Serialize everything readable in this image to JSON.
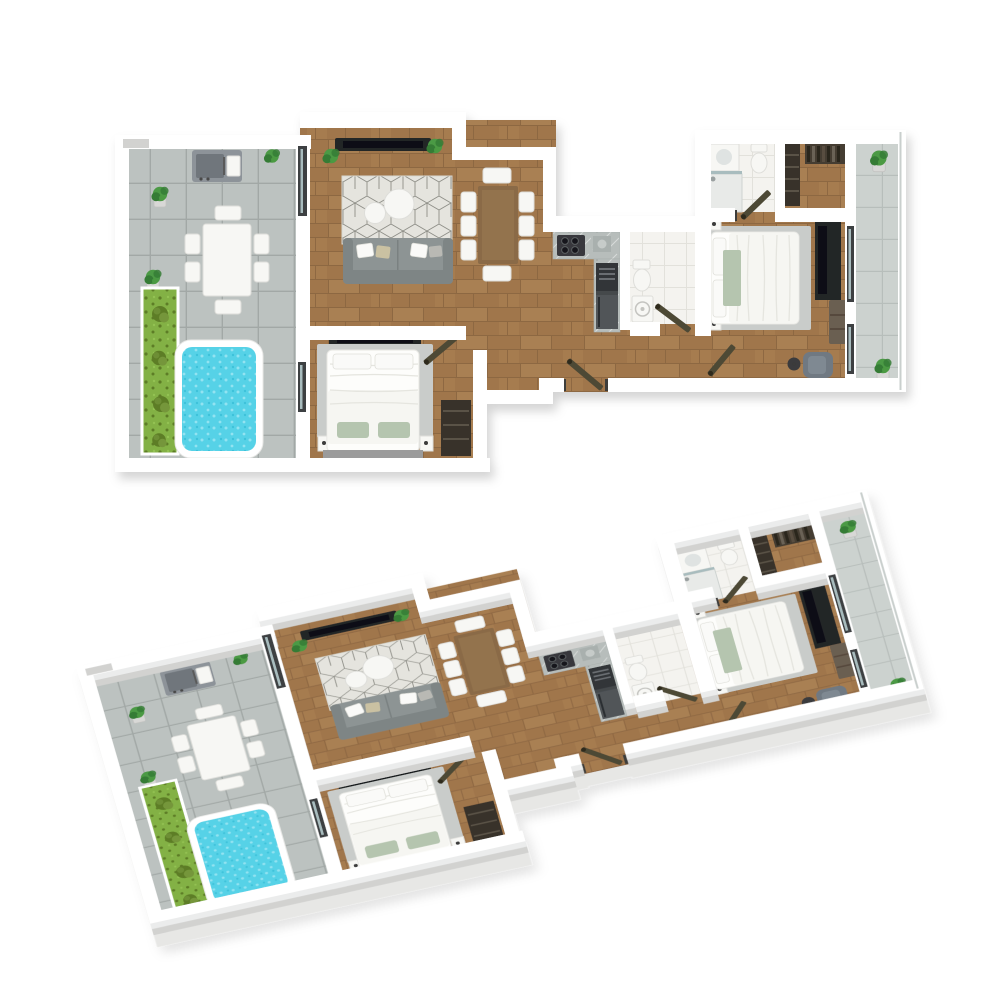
{
  "scene": {
    "description": "Two 3D renderings of the same two-bedroom apartment floor plan on a white background",
    "views": [
      {
        "id": "top",
        "label": "Top-down 3D floor plan view"
      },
      {
        "id": "iso",
        "label": "Isometric 3D floor plan view"
      }
    ]
  },
  "rooms": [
    "terrace-with-pool",
    "living-room",
    "dining-area",
    "kitchen",
    "hallway",
    "bathroom",
    "ensuite-bathroom",
    "master-bedroom",
    "second-bedroom",
    "walk-in-wardrobe",
    "balcony"
  ],
  "furniture": [
    "barbecue-grill",
    "outdoor-dining-table-with-chairs",
    "swimming-pool",
    "grass-strip-with-shrubs",
    "potted-plants",
    "wall-mounted-tv",
    "area-rug",
    "round-coffee-tables",
    "sofa-with-cushions",
    "wooden-dining-table-with-chairs",
    "kitchen-counter-with-cooktop",
    "oven-and-fridge-column",
    "toilet",
    "washing-machine",
    "shower",
    "vanity-sink",
    "double-bed",
    "nightstands",
    "tv-sideboard",
    "dresser-drawers",
    "armchair-with-side-table",
    "wardrobe-shelving",
    "glass-balcony-railing",
    "interior-doors"
  ],
  "palette": {
    "wall": "#ffffff",
    "wood": "#a0764b",
    "wood-line": "#8a6440",
    "wood-light": "#b28a5c",
    "tile": "#bcc2c0",
    "tile-line": "#a2a8a6",
    "tile-light": "#ccd2cf",
    "tile-light-line": "#b7bebb",
    "bath-floor": "#f4f3ef",
    "bath-line": "#e2e1db",
    "rug-light": "#e5e4de",
    "rug-line": "#8e8e87",
    "rug-gray": "#c9ccca",
    "pool": "#57d2e7",
    "pool-dot": "#93e3f1",
    "pool-deep": "#3ec2da",
    "grass": "#83b144",
    "grass-dark": "#5d7d27",
    "sofa": "#8d9494",
    "sofa-dark": "#7e8585",
    "tv": "#232528",
    "tv-screen": "#0f1012",
    "door": "#4e4936",
    "white-furniture": "#f7f7f4",
    "furniture-stroke": "#dededa",
    "wood-furniture": "#8a6a46",
    "marble": "#b7bdbb",
    "appliance": "#45484c",
    "plant": "#4c9a44",
    "plant-dark": "#357c35",
    "blanket": "#b5c5af",
    "armchair": "#707982",
    "wardrobe": "#39322a",
    "wardrobe-line": "#5a5246",
    "glass": "#a8bcbe",
    "window-frame": "#3c4042",
    "metal": "#8d9399",
    "metal-dark": "#70767c",
    "niche": "#d2d2d0"
  }
}
